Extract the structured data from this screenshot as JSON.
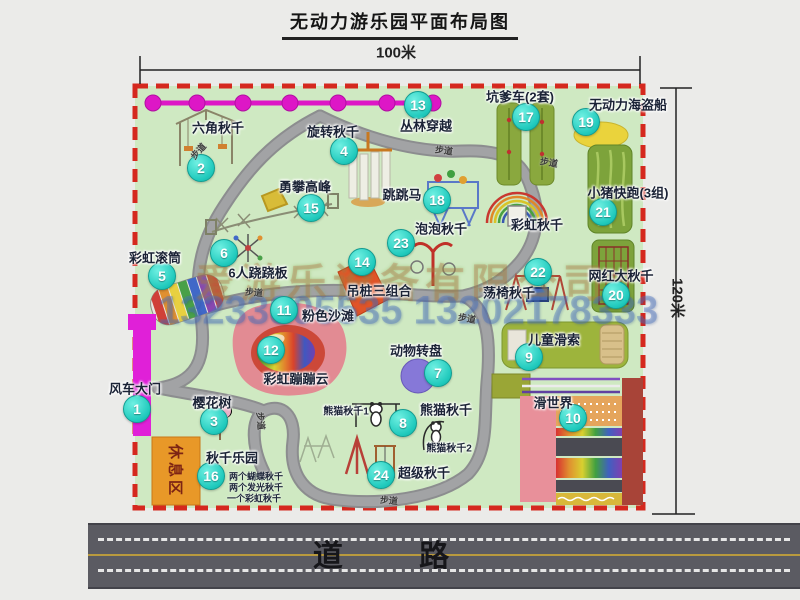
{
  "title": "无动力游乐园平面布局图",
  "dimensions": {
    "top": "100米",
    "right": "120米"
  },
  "road_label": "道 路",
  "watermark": {
    "company": "爱游乐设备有限公司",
    "phone": "13233805535 13202178333"
  },
  "rest_area_label": "休息区",
  "walkway_label": "步道",
  "legend_items": [
    {
      "num": "1",
      "label": "风车大门"
    },
    {
      "num": "2",
      "label": "六角秋千"
    },
    {
      "num": "3",
      "label": "樱花树"
    },
    {
      "num": "4",
      "label": "旋转秋千"
    },
    {
      "num": "5",
      "label": "彩虹滚筒"
    },
    {
      "num": "6",
      "label": "6人跷跷板"
    },
    {
      "num": "7",
      "label": "动物转盘"
    },
    {
      "num": "8",
      "label": "熊猫秋千"
    },
    {
      "num": "9",
      "label": "儿童滑索"
    },
    {
      "num": "10",
      "label": "滑世界"
    },
    {
      "num": "11",
      "label": "粉色沙滩"
    },
    {
      "num": "12",
      "label": "彩虹蹦蹦云"
    },
    {
      "num": "13",
      "label": "丛林穿越"
    },
    {
      "num": "14",
      "label": "吊桩三组合"
    },
    {
      "num": "15",
      "label": "勇攀高峰"
    },
    {
      "num": "16",
      "label": "秋千乐园"
    },
    {
      "num": "17",
      "label": "坑爹车(2套)"
    },
    {
      "num": "18",
      "label": "跳跳马"
    },
    {
      "num": "19",
      "label": "无动力海盗船"
    },
    {
      "num": "20",
      "label": "网红大秋千"
    },
    {
      "num": "21",
      "label": "小猪快跑(3组)"
    },
    {
      "num": "22",
      "label": "荡椅秋千"
    },
    {
      "num": "23",
      "label": "泡泡秋千"
    },
    {
      "num": "24",
      "label": "超级秋千"
    }
  ],
  "extra_labels": {
    "rainbow_swing": "彩虹秋千",
    "panda_swing_1": "熊猫秋千1",
    "panda_swing_2": "熊猫秋千2",
    "swing_park_notes": [
      "两个蝴蝶秋千",
      "两个发光秋千",
      "一个彩虹秋千"
    ]
  },
  "colors": {
    "park_fill": "#cfe9c2",
    "border_red": "#d5281e",
    "badge_cyan": "#1fc9bc",
    "zipline_magenta": "#dd17c6",
    "gate_magenta": "#e020d8",
    "rest_area_orange": "#e89828",
    "road_gray": "#5b5b62"
  }
}
